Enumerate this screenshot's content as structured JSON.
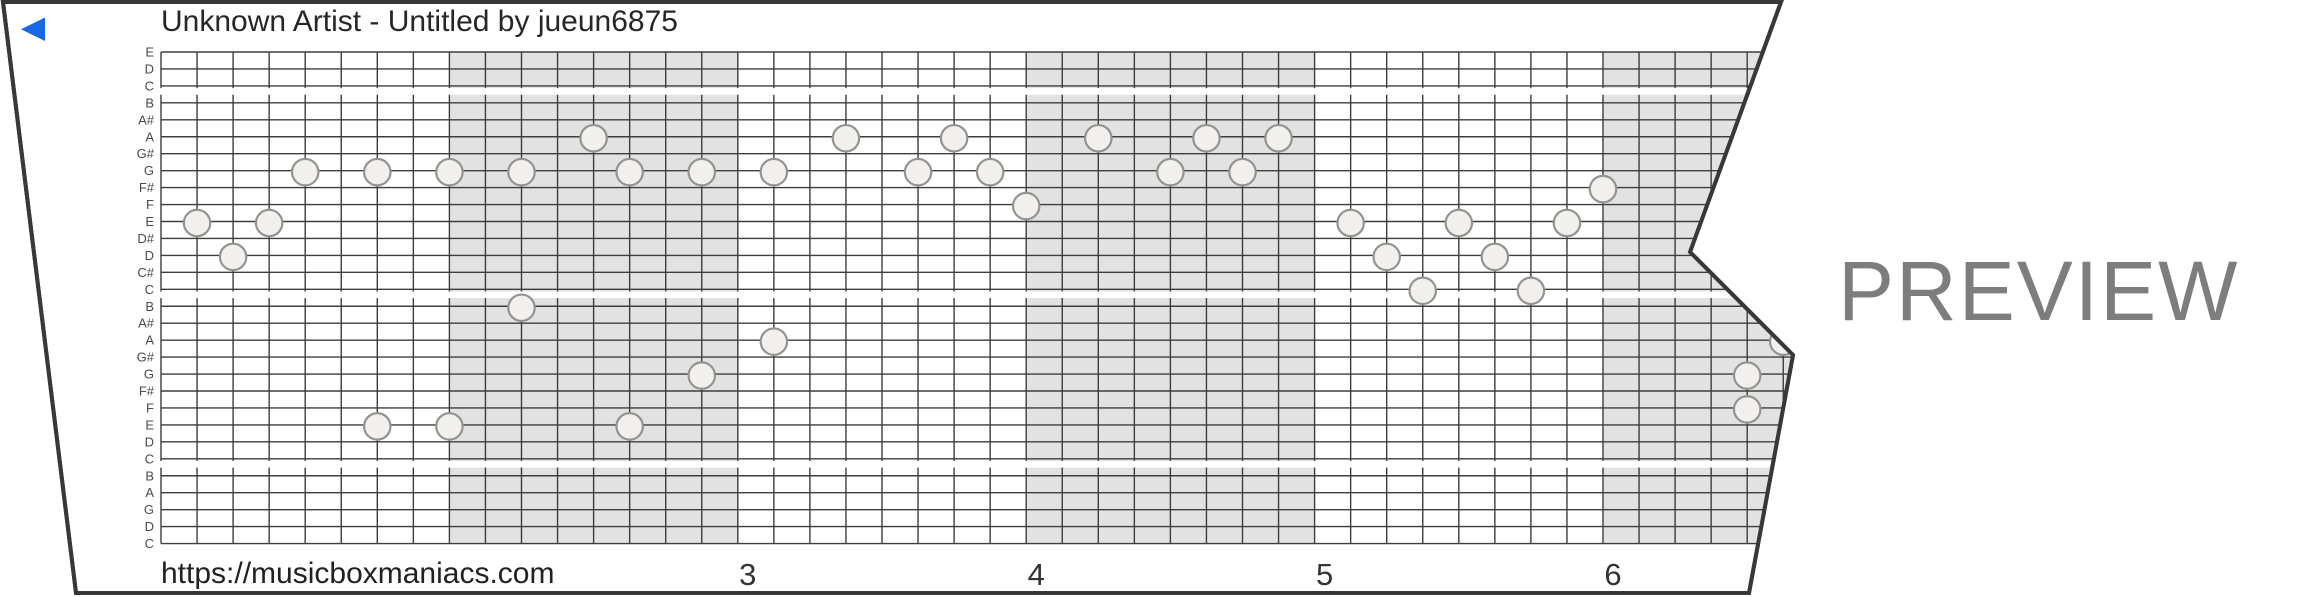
{
  "header": {
    "title": "Unknown Artist - Untitled by jueun6875"
  },
  "footer": {
    "url": "https://musicboxmaniacs.com"
  },
  "watermark_label": "PREVIEW",
  "player": {
    "play_icon_color": "#1768e4"
  },
  "colors": {
    "paper_fill": "#ffffff",
    "paper_edge": "#383838",
    "grid_line": "#3d3d3d",
    "measure_shading": "#e2e2e2",
    "note_fill": "#f1f0ee",
    "note_stroke": "#95938d",
    "label_color": "#4a4a4a",
    "number_color": "#333333",
    "watermark_color": "#7d7d7d",
    "title_color": "#262626"
  },
  "strip": {
    "row_labels": [
      "E",
      "D",
      "C",
      "B",
      "A#",
      "A",
      "G#",
      "G",
      "F#",
      "F",
      "E",
      "D#",
      "D",
      "C#",
      "C",
      "B",
      "A#",
      "A",
      "G#",
      "G",
      "F#",
      "F",
      "E",
      "D",
      "C",
      "B",
      "A",
      "G",
      "D",
      "C"
    ],
    "octave_gap_after_rows": [
      2,
      14,
      24
    ],
    "columns_per_measure": 8,
    "shaded_measures": [
      1,
      3,
      5
    ],
    "measure_numbers": [
      {
        "measure": 2,
        "label": "3"
      },
      {
        "measure": 3,
        "label": "4"
      },
      {
        "measure": 4,
        "label": "5"
      },
      {
        "measure": 5,
        "label": "6"
      }
    ],
    "notes": [
      {
        "col": 1,
        "row": 10,
        "pitch": "E5"
      },
      {
        "col": 2,
        "row": 12,
        "pitch": "D5"
      },
      {
        "col": 3,
        "row": 10,
        "pitch": "E5"
      },
      {
        "col": 4,
        "row": 7,
        "pitch": "G5"
      },
      {
        "col": 6,
        "row": 7,
        "pitch": "G5"
      },
      {
        "col": 6,
        "row": 22,
        "pitch": "E4"
      },
      {
        "col": 8,
        "row": 7,
        "pitch": "G5"
      },
      {
        "col": 8,
        "row": 22,
        "pitch": "E4"
      },
      {
        "col": 10,
        "row": 7,
        "pitch": "G5"
      },
      {
        "col": 10,
        "row": 15,
        "pitch": "B4"
      },
      {
        "col": 12,
        "row": 5,
        "pitch": "A5"
      },
      {
        "col": 13,
        "row": 7,
        "pitch": "G5"
      },
      {
        "col": 13,
        "row": 22,
        "pitch": "E4"
      },
      {
        "col": 15,
        "row": 7,
        "pitch": "G5"
      },
      {
        "col": 15,
        "row": 19,
        "pitch": "G4"
      },
      {
        "col": 17,
        "row": 7,
        "pitch": "G5"
      },
      {
        "col": 17,
        "row": 17,
        "pitch": "A4"
      },
      {
        "col": 19,
        "row": 5,
        "pitch": "A5"
      },
      {
        "col": 21,
        "row": 7,
        "pitch": "G5"
      },
      {
        "col": 22,
        "row": 5,
        "pitch": "A5"
      },
      {
        "col": 23,
        "row": 7,
        "pitch": "G5"
      },
      {
        "col": 24,
        "row": 9,
        "pitch": "F5"
      },
      {
        "col": 26,
        "row": 5,
        "pitch": "A5"
      },
      {
        "col": 28,
        "row": 7,
        "pitch": "G5"
      },
      {
        "col": 29,
        "row": 5,
        "pitch": "A5"
      },
      {
        "col": 30,
        "row": 7,
        "pitch": "G5"
      },
      {
        "col": 31,
        "row": 5,
        "pitch": "A5"
      },
      {
        "col": 33,
        "row": 10,
        "pitch": "E5"
      },
      {
        "col": 34,
        "row": 12,
        "pitch": "D5"
      },
      {
        "col": 35,
        "row": 14,
        "pitch": "C5"
      },
      {
        "col": 36,
        "row": 10,
        "pitch": "E5"
      },
      {
        "col": 37,
        "row": 12,
        "pitch": "D5"
      },
      {
        "col": 38,
        "row": 14,
        "pitch": "C5"
      },
      {
        "col": 39,
        "row": 10,
        "pitch": "E5"
      },
      {
        "col": 40,
        "row": 8,
        "pitch": "F#5"
      },
      {
        "col": 44,
        "row": 19,
        "pitch": "G4"
      },
      {
        "col": 44,
        "row": 21,
        "pitch": "F4"
      },
      {
        "col": 45,
        "row": 17,
        "pitch": "A4"
      }
    ]
  }
}
